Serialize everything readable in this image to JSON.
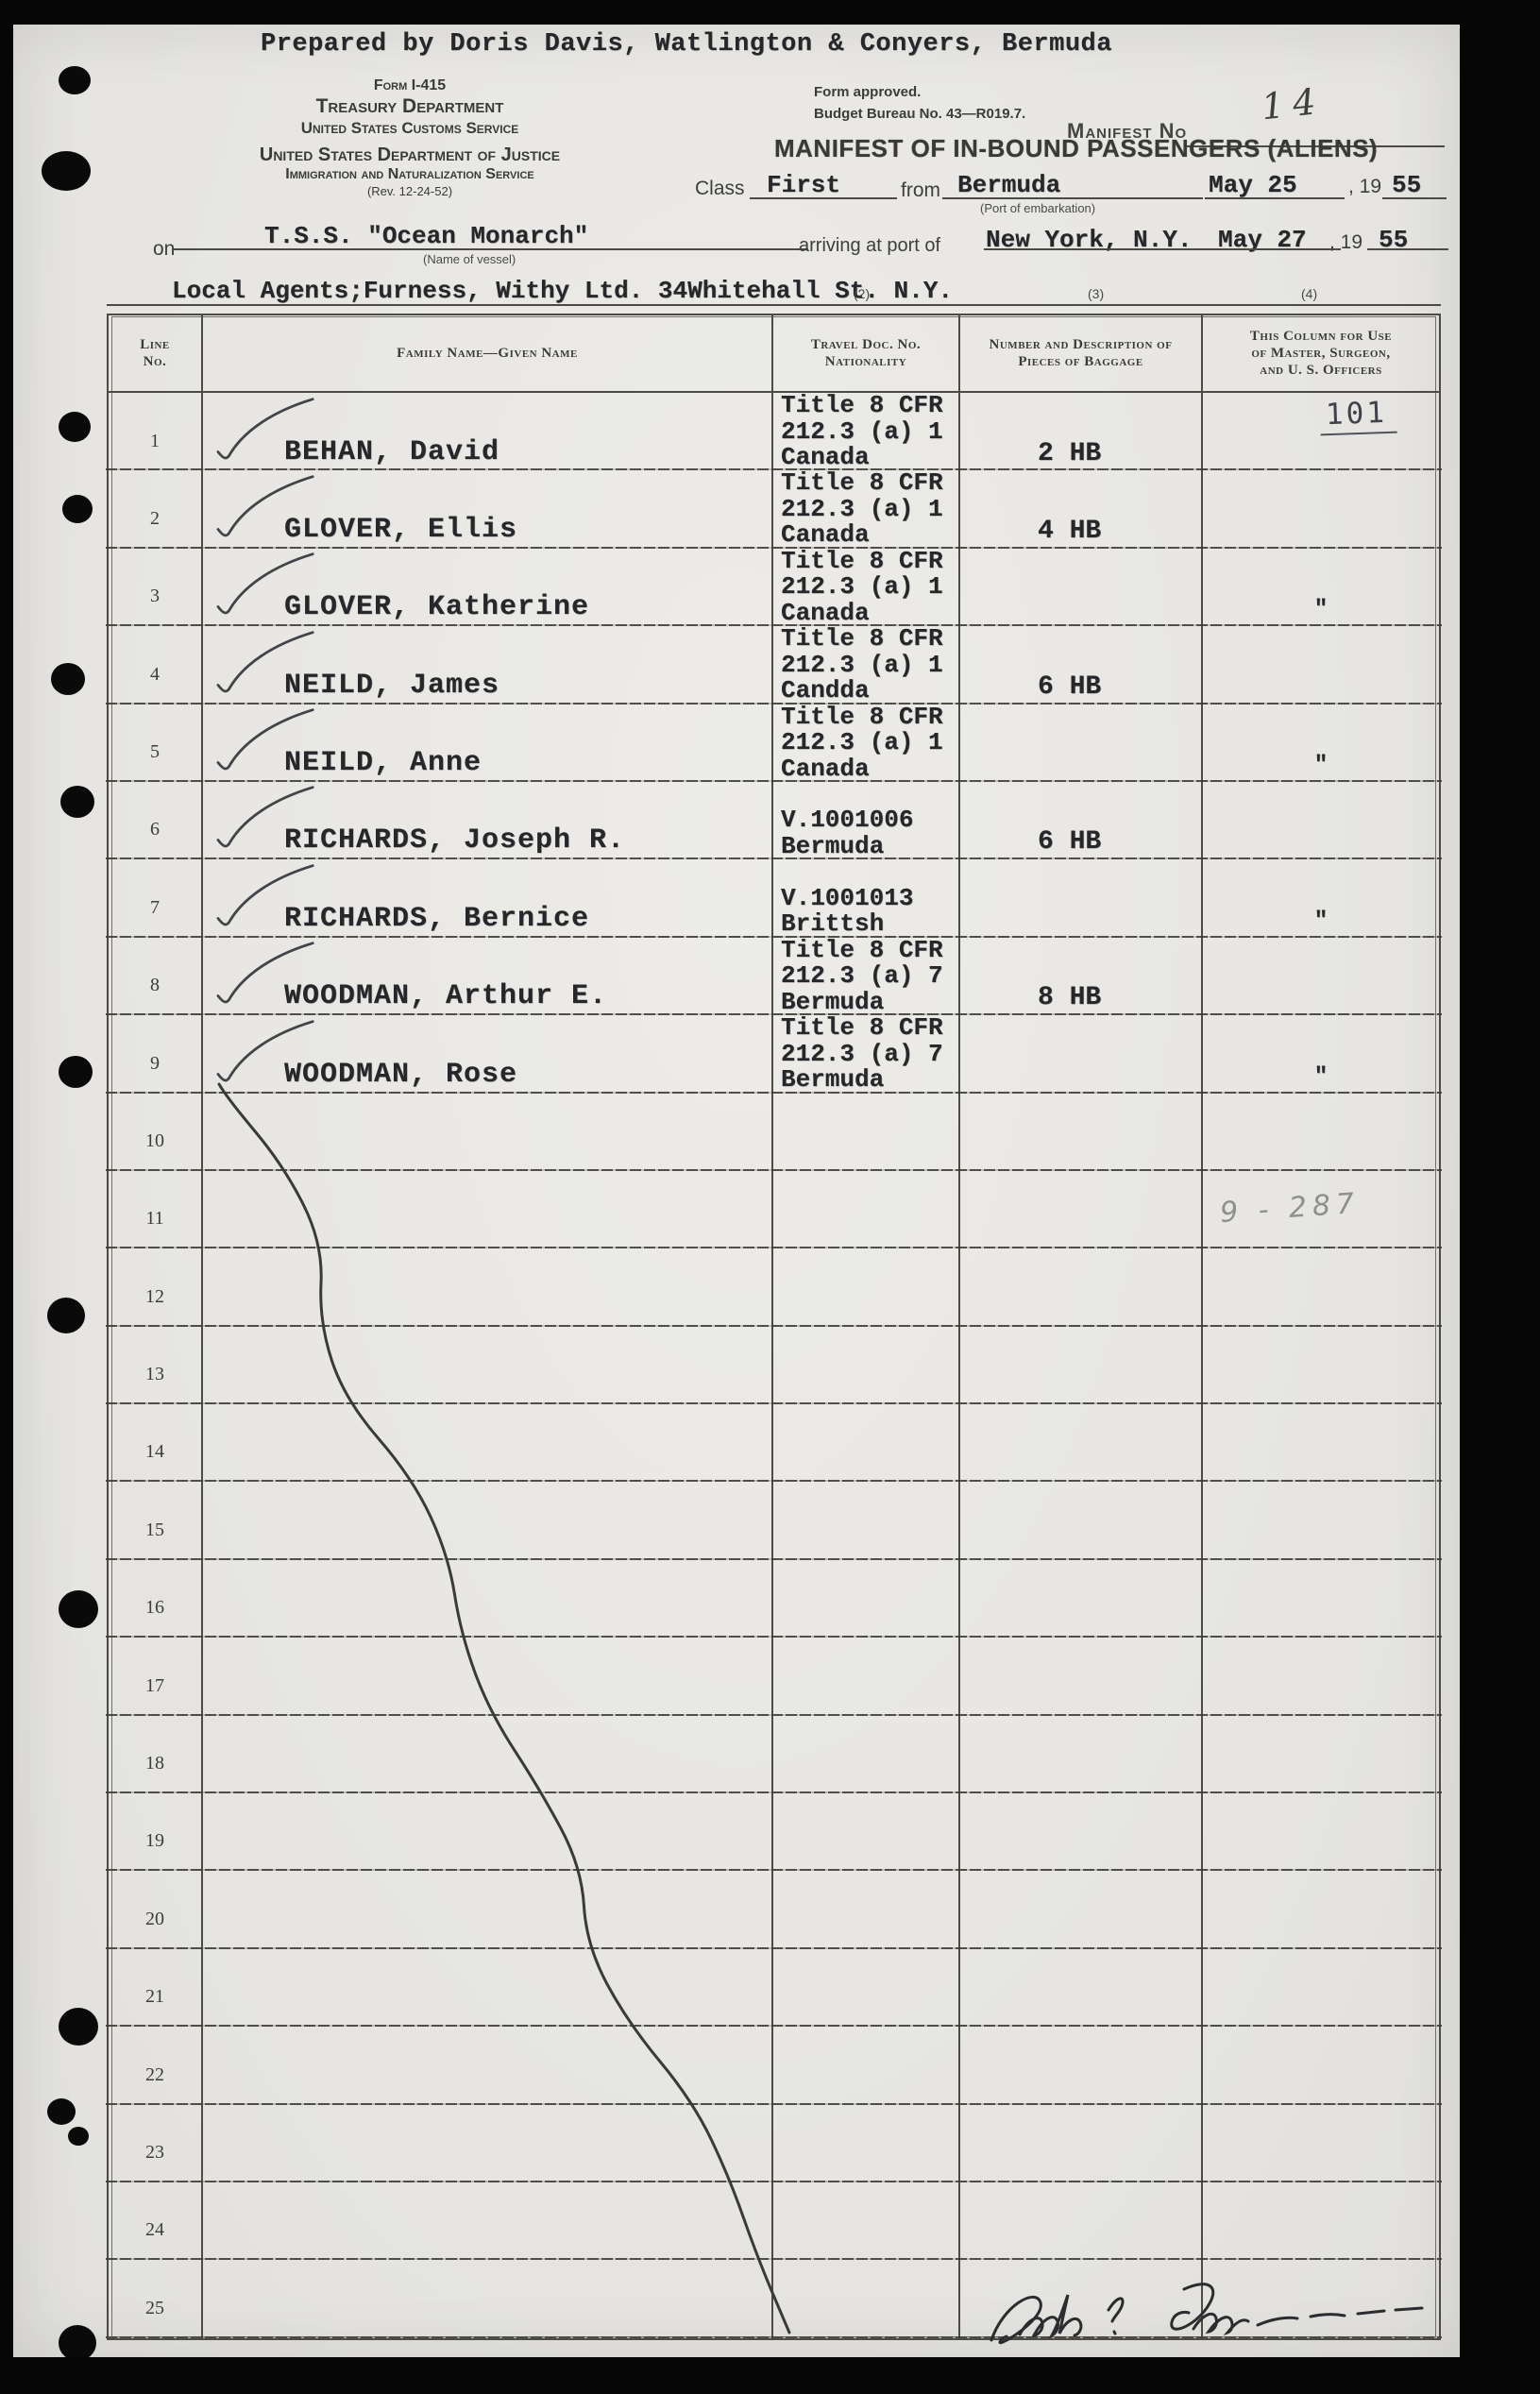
{
  "colors": {
    "paper": "#e8e7e3",
    "scan_background": "#060606",
    "typed_ink": "#27272b",
    "printed_ink": "#3e3e3e",
    "pencil": "#8f8f8d"
  },
  "header": {
    "prepared_by": "Prepared by Doris Davis, Watlington & Conyers, Bermuda",
    "form_block": {
      "lines": [
        "Form I-415",
        "Treasury Department",
        "United States Customs Service",
        "United States Department of Justice",
        "Immigration and Naturalization Service",
        "(Rev. 12-24-52)"
      ]
    },
    "approval": {
      "lines": [
        "Form approved.",
        "Budget Bureau No. 43—R019.7."
      ]
    },
    "manifest_no_label": "Manifest No",
    "manifest_no_value": "14",
    "title": "MANIFEST OF IN-BOUND PASSENGERS (ALIENS)",
    "class_line": {
      "class_label": "Class",
      "class_value": "First",
      "from_label": "from",
      "from_value": "Bermuda",
      "port_caption": "(Port of embarkation)",
      "date": "May 25",
      "year_printed": ", 19",
      "year": "55"
    },
    "vessel_line": {
      "on_label": "on",
      "vessel": "T.S.S. \"Ocean Monarch\"",
      "vessel_caption": "(Name of vessel)",
      "arriving_label": "arriving at port of",
      "port": "New York, N.Y.",
      "date": "May 27",
      "year_printed": ", 19",
      "year": "55"
    },
    "agents_line": {
      "text": "Local Agents;Furness, Withy Ltd. 34Whitehall St. N.Y.",
      "ref2": "(2)",
      "ref3": "(3)",
      "ref4": "(4)"
    }
  },
  "table": {
    "headers": {
      "line_no": "Line\nNo.",
      "name": "Family Name—Given Name",
      "travel_doc": "Travel Doc. No.\nNationality",
      "baggage": "Number and Description of\nPieces of Baggage",
      "officer": "This Column for Use\nof Master, Surgeon,\nand U. S. Officers"
    },
    "rows": [
      {
        "no": "1",
        "name": "BEHAN, David",
        "doc": "Title 8 CFR\n212.3 (a) 1\nCanada",
        "baggage": "2 HB",
        "officer": "",
        "check": true
      },
      {
        "no": "2",
        "name": "GLOVER, Ellis",
        "doc": "Title 8 CFR\n212.3 (a) 1\nCanada",
        "baggage": "4 HB",
        "officer": "",
        "check": true
      },
      {
        "no": "3",
        "name": "GLOVER, Katherine",
        "doc": "Title 8 CFR\n212.3 (a) 1\nCanada",
        "baggage": "",
        "officer": "″",
        "check": true
      },
      {
        "no": "4",
        "name": "NEILD, James",
        "doc": "Title 8 CFR\n212.3 (a) 1\nCandda",
        "baggage": "6 HB",
        "officer": "",
        "check": true
      },
      {
        "no": "5",
        "name": "NEILD, Anne",
        "doc": "Title 8 CFR\n212.3 (a) 1\nCanada",
        "baggage": "",
        "officer": "″",
        "check": true
      },
      {
        "no": "6",
        "name": "RICHARDS, Joseph R.",
        "doc": "V.1001006\nBermuda",
        "baggage": "6 HB",
        "officer": "",
        "check": true
      },
      {
        "no": "7",
        "name": "RICHARDS, Bernice",
        "doc": "V.1001013\nBrittsh",
        "baggage": "",
        "officer": "″",
        "check": true
      },
      {
        "no": "8",
        "name": "WOODMAN, Arthur E.",
        "doc": "Title 8 CFR\n212.3 (a) 7\nBermuda",
        "baggage": "8 HB",
        "officer": "",
        "check": true
      },
      {
        "no": "9",
        "name": "WOODMAN, Rose",
        "doc": "Title 8 CFR\n212.3 (a) 7\nBermuda",
        "baggage": "",
        "officer": "″",
        "check": true
      },
      {
        "no": "10",
        "name": "",
        "doc": "",
        "baggage": "",
        "officer": "",
        "check": false
      },
      {
        "no": "11",
        "name": "",
        "doc": "",
        "baggage": "",
        "officer": "",
        "check": false
      },
      {
        "no": "12",
        "name": "",
        "doc": "",
        "baggage": "",
        "officer": "",
        "check": false
      },
      {
        "no": "13",
        "name": "",
        "doc": "",
        "baggage": "",
        "officer": "",
        "check": false
      },
      {
        "no": "14",
        "name": "",
        "doc": "",
        "baggage": "",
        "officer": "",
        "check": false
      },
      {
        "no": "15",
        "name": "",
        "doc": "",
        "baggage": "",
        "officer": "",
        "check": false
      },
      {
        "no": "16",
        "name": "",
        "doc": "",
        "baggage": "",
        "officer": "",
        "check": false
      },
      {
        "no": "17",
        "name": "",
        "doc": "",
        "baggage": "",
        "officer": "",
        "check": false
      },
      {
        "no": "18",
        "name": "",
        "doc": "",
        "baggage": "",
        "officer": "",
        "check": false
      },
      {
        "no": "19",
        "name": "",
        "doc": "",
        "baggage": "",
        "officer": "",
        "check": false
      },
      {
        "no": "20",
        "name": "",
        "doc": "",
        "baggage": "",
        "officer": "",
        "check": false
      },
      {
        "no": "21",
        "name": "",
        "doc": "",
        "baggage": "",
        "officer": "",
        "check": false
      },
      {
        "no": "22",
        "name": "",
        "doc": "",
        "baggage": "",
        "officer": "",
        "check": false
      },
      {
        "no": "23",
        "name": "",
        "doc": "",
        "baggage": "",
        "officer": "",
        "check": false
      },
      {
        "no": "24",
        "name": "",
        "doc": "",
        "baggage": "",
        "officer": "",
        "check": false
      },
      {
        "no": "25",
        "name": "",
        "doc": "",
        "baggage": "",
        "officer": "",
        "check": false
      }
    ]
  },
  "annotations": {
    "stamp_101": "101",
    "pencil_note": "9 - 287",
    "signature_transcription": "Carla B Johnson"
  }
}
